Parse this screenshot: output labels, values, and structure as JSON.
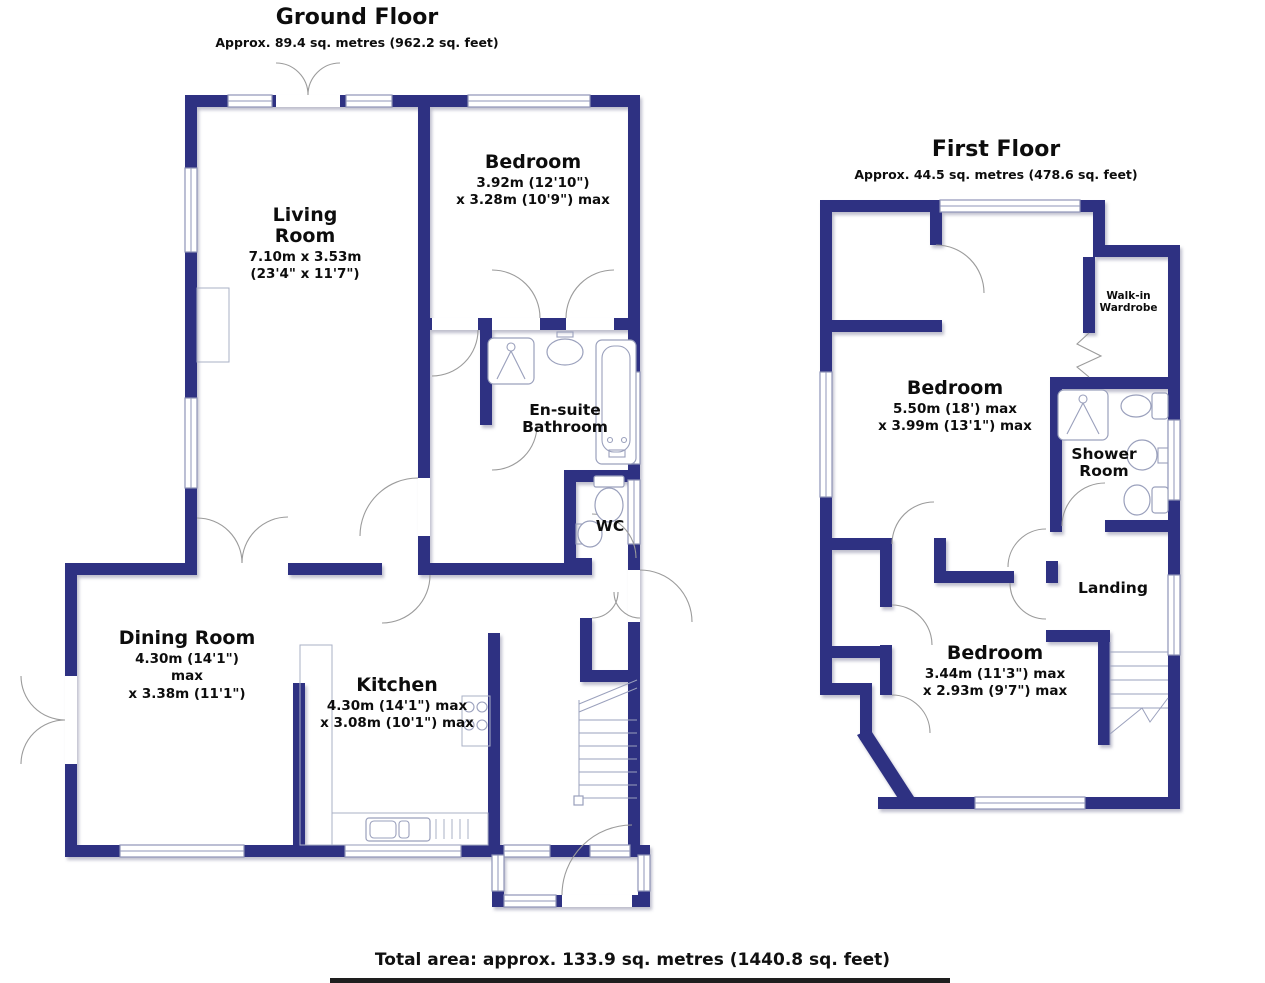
{
  "ground_floor": {
    "title": "Ground Floor",
    "subtitle": "Approx. 89.4 sq. metres (962.2 sq. feet)",
    "rooms": {
      "living": {
        "name": "Living Room",
        "dims": [
          "7.10m x 3.53m",
          "(23'4\" x 11'7\")"
        ]
      },
      "bedroom": {
        "name": "Bedroom",
        "dims": [
          "3.92m (12'10\")",
          "x 3.28m (10'9\") max"
        ]
      },
      "ensuite": {
        "name": "En-suite Bathroom",
        "dims": []
      },
      "wc": {
        "name": "WC",
        "dims": []
      },
      "dining": {
        "name": "Dining Room",
        "dims": [
          "4.30m (14'1\") max",
          "x 3.38m (11'1\")"
        ]
      },
      "kitchen": {
        "name": "Kitchen",
        "dims": [
          "4.30m (14'1\") max",
          "x 3.08m (10'1\") max"
        ]
      }
    }
  },
  "first_floor": {
    "title": "First Floor",
    "subtitle": "Approx. 44.5 sq. metres (478.6 sq. feet)",
    "rooms": {
      "bedroom1": {
        "name": "Bedroom",
        "dims": [
          "5.50m (18') max",
          "x 3.99m (13'1\") max"
        ]
      },
      "wardrobe": {
        "name": "Walk-in Wardrobe",
        "dims": []
      },
      "shower": {
        "name": "Shower Room",
        "dims": []
      },
      "landing": {
        "name": "Landing",
        "dims": []
      },
      "bedroom2": {
        "name": "Bedroom",
        "dims": [
          "3.44m (11'3\") max",
          "x 2.93m (9'7\") max"
        ]
      }
    }
  },
  "footer": {
    "total": "Total area: approx. 133.9 sq. metres (1440.8 sq. feet)"
  },
  "colors": {
    "wall": "#2e3182",
    "window_line": "#8f94b8",
    "door_line": "#9b9b9b"
  }
}
